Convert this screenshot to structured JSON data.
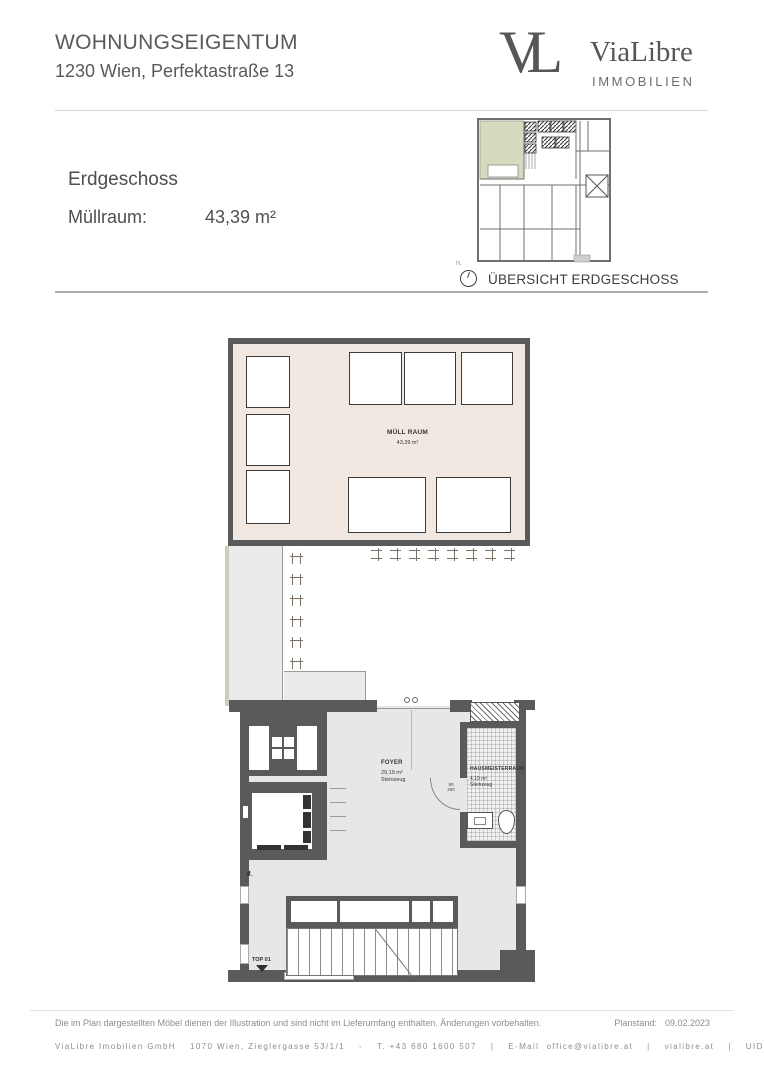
{
  "header": {
    "title": "WOHNUNGSEIGENTUM",
    "subtitle": "1230 Wien, Perfektastraße 13",
    "logo_monogram": "VL",
    "logo_name": "ViaLibre",
    "logo_tagline": "IMMOBILIEN"
  },
  "summary": {
    "floor_title": "Erdgeschoss",
    "room_label": "Müllraum:",
    "room_area": "43,39 m²"
  },
  "overview": {
    "caption": "ÜBERSICHT ERDGESCHOSS",
    "compass_label": "N."
  },
  "plan": {
    "muellraum_name": "MÜLL RAUM",
    "muellraum_area": "43,39 m²",
    "foyer_name": "FOYER",
    "foyer_area": "29,19 m²",
    "foyer_finish": "Steinzeug",
    "hausmeister_name": "HAUSMEISTERRAUM",
    "hausmeister_area": "4,19 m²",
    "hausmeister_finish": "Steinzeug",
    "door_width": "80",
    "door_height": "200",
    "unit_label": "TOP 01"
  },
  "footer": {
    "disclaimer": "Die im Plan dargestellten Möbel dienen der Illustration und sind nicht im Lieferumfang enthalten. Änderungen vorbehalten.",
    "plan_date_label": "Planstand:",
    "plan_date": "09.02.2023",
    "company": "ViaLibre Imobilien GmbH",
    "address": "1070 Wien, Zieglergasse 53/1/1",
    "sep_dash": "-",
    "sep_pipe": "|",
    "phone": "T. +43 680 1600 507",
    "email_label": "E-Mail",
    "email": "office@vialibre.at",
    "website": "vialibre.at",
    "uid": "UID ATU77818435"
  },
  "colors": {
    "wall": "#5a5a5a",
    "muellraum_floor": "#f1e8e1",
    "foyer_floor": "#e7e7e7",
    "outdoor": "#ebebeb",
    "lawn_green": "#cbd1b4",
    "overview_green": "#d6dbbf",
    "text_dark": "#4e4e4e",
    "footer_text": "#8d8d8d"
  }
}
